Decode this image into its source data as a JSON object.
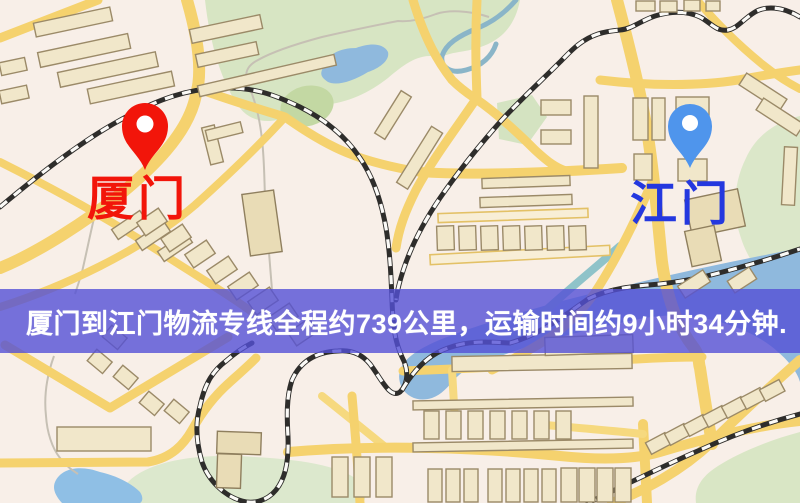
{
  "map": {
    "type": "logistics-route-map",
    "origin": {
      "name": "厦门",
      "pin_color": "#f2150a",
      "label_color": "#f2150a"
    },
    "destination": {
      "name": "江门",
      "pin_color": "#4f95ec",
      "label_color": "#2438df"
    },
    "banner": {
      "text": "厦门到江门物流专线全程约739公里，运输时间约9小时34分钟.",
      "distance_km": "739",
      "duration": "9小时34分钟",
      "background_color": "#5450d6",
      "text_color": "#ffffff"
    },
    "palette": {
      "map_background": "#f8efe8",
      "road": "#f5d26e",
      "park": "#d7e5c3",
      "water": "#8fb9dd",
      "building_fill": "#f1e7ca",
      "building_stroke": "#9b8a68"
    }
  }
}
